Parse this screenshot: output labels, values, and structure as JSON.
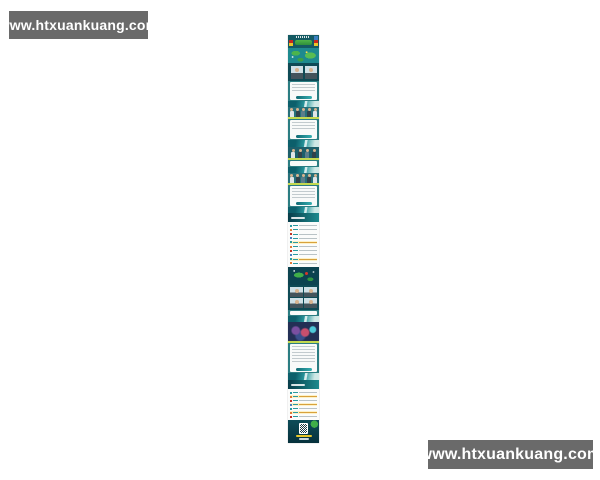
{
  "page": {
    "background": "#ffffff"
  },
  "watermark_top": {
    "text": "www.htxuankuang.com"
  },
  "watermark_bottom": {
    "text": "www.htxuankuang.com"
  },
  "poster": {
    "description": "tall narrow preview of a long teal-and-green Chinese event/H5 poster image (text illegible at this scale)",
    "palette": {
      "dark_teal": "#0e4a55",
      "teal": "#1e8a8f",
      "wave_teal": "#2a9aa0",
      "green": "#46b14b",
      "light_green": "#c3d94f",
      "flag_red": "#c8281e",
      "flag_yellow": "#e8c62a",
      "logo_blue": "#3b7ec0",
      "card_white": "#f8faf9",
      "text_line_gray": "#c2cbce",
      "highlight_yellow": "#fdf2c6",
      "accent_red": "#d6352b",
      "skin": "#d8b48f"
    },
    "sections": [
      {
        "name": "header-flags",
        "type": "flags",
        "h": 13,
        "bg": "#145a63"
      },
      {
        "name": "world-map",
        "type": "map",
        "h": 15
      },
      {
        "name": "speaker-portraits",
        "type": "portraits2",
        "h": 18,
        "bg": "#0e4a55"
      },
      {
        "name": "intro-text-card",
        "type": "card",
        "h": 20,
        "bg": "#2b7d82",
        "button": true
      },
      {
        "name": "wave-divider-1",
        "type": "wave",
        "h": 6
      },
      {
        "name": "group-photo-1",
        "type": "people",
        "h": 12,
        "bg": "#27707a",
        "figures": 5
      },
      {
        "name": "session-text-card-1",
        "type": "card",
        "h": 21,
        "bg": "#2b7d82",
        "button": true
      },
      {
        "name": "wave-divider-2",
        "type": "wave",
        "h": 7
      },
      {
        "name": "group-photo-2",
        "type": "people",
        "h": 13,
        "bg": "#1d5f6b",
        "figures": 4
      },
      {
        "name": "session-text-card-2",
        "type": "card",
        "h": 7,
        "bg": "#2b7d82"
      },
      {
        "name": "wave-divider-3",
        "type": "wave",
        "h": 6
      },
      {
        "name": "group-photo-3",
        "type": "people",
        "h": 12,
        "bg": "#27707a",
        "figures": 5
      },
      {
        "name": "session-text-card-3",
        "type": "card",
        "h": 22,
        "bg": "#2b7d82",
        "button": true
      },
      {
        "name": "wave-divider-4",
        "type": "wave",
        "h": 6
      },
      {
        "name": "agenda-header-1",
        "type": "band",
        "h": 9
      },
      {
        "name": "agenda-list-1",
        "type": "list",
        "h": 45,
        "bg": "#fbfcfb",
        "rows": 10,
        "highlights": [
          4,
          8
        ]
      },
      {
        "name": "dark-map-section",
        "type": "map2",
        "h": 18,
        "bg": "#0c4350"
      },
      {
        "name": "guest-portrait-grid",
        "type": "portraits4",
        "h": 25,
        "bg": "#0e4a55"
      },
      {
        "name": "note-card",
        "type": "card",
        "h": 6,
        "bg": "#2b7d82"
      },
      {
        "name": "wave-divider-5",
        "type": "wave",
        "h": 6
      },
      {
        "name": "crowd-photo",
        "type": "photo",
        "h": 21,
        "bg": "#232f55"
      },
      {
        "name": "summary-text-card",
        "type": "card",
        "h": 30,
        "bg": "#2b7d82",
        "button": true
      },
      {
        "name": "wave-divider-6",
        "type": "wave",
        "h": 7
      },
      {
        "name": "agenda-header-2",
        "type": "band",
        "h": 9
      },
      {
        "name": "agenda-list-2",
        "type": "list",
        "h": 31,
        "bg": "#fbfcfb",
        "rows": 7,
        "highlights": [
          1,
          3,
          5
        ]
      },
      {
        "name": "footer-qr",
        "type": "footer",
        "h": 23
      }
    ]
  }
}
